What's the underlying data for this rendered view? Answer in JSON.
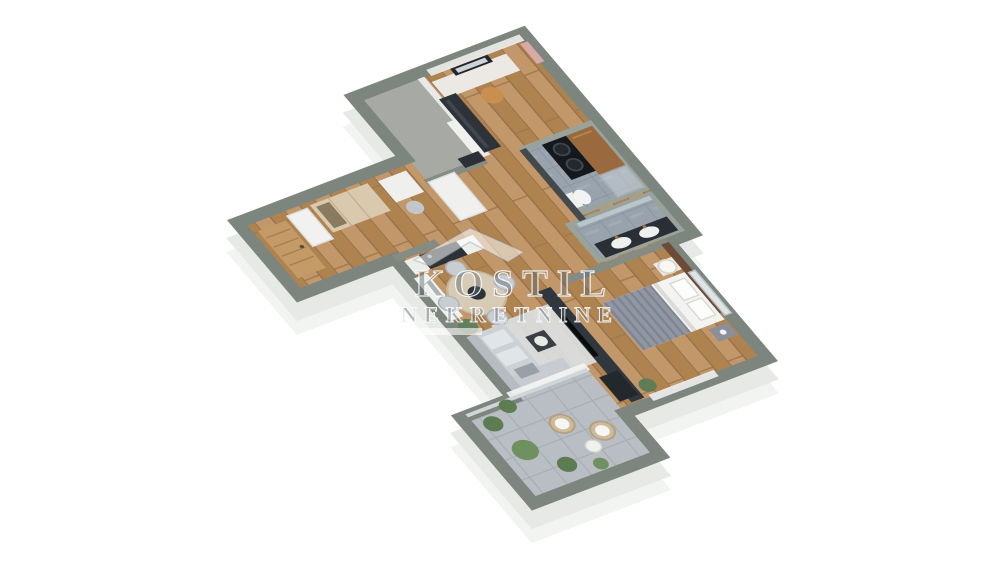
{
  "watermark": {
    "brand": "KOSTIL",
    "subtitle": "NEKRETNINE",
    "icon": "house-roof-icon"
  },
  "colors": {
    "background": "#ffffff",
    "exterior_wall": "#7d867e",
    "interior_partition": "#e8eae8",
    "wood_floor": "#b98f63",
    "bathroom_tile": "#99a3ad",
    "balcony_tile": "#b8bec4",
    "loggia_concrete": "#a7a9a4",
    "sofa_gray": "#ccd1d6",
    "tv_wall_dark": "#31373e",
    "entry_door_wood": "#c49a66",
    "cabinet_wood": "#9a6a3e",
    "plant_green": "#5f7d54",
    "bed_linen": "#f3f3f1",
    "blanket_gray": "#9096a2"
  },
  "floorplan": {
    "view": "isometric-3d-apartment-render",
    "rooms": [
      {
        "name": "top-bedroom-office",
        "furniture": "desk, mirror, tan chair, dark wardrobe, curtains"
      },
      {
        "name": "loggia",
        "furniture": "concrete floor"
      },
      {
        "name": "laundry-bathroom",
        "furniture": "stacked washer-dryer, wood cabinet, toilet, shower"
      },
      {
        "name": "main-bathroom",
        "furniture": "double sink vanity, mirror"
      },
      {
        "name": "bedroom",
        "furniture": "double bed, nightstands, lamp, window, plant"
      },
      {
        "name": "kitchen-dining",
        "furniture": "counter with cooktop, round dining table, four chairs, plant"
      },
      {
        "name": "living-room",
        "furniture": "corner sofa, coffee table, rug, TV wall, sideboard"
      },
      {
        "name": "entry-hall",
        "furniture": "wooden front door, shelf unit, wardrobe, desk nook"
      },
      {
        "name": "balcony",
        "furniture": "two wicker chairs, round table, potted plants"
      }
    ]
  }
}
